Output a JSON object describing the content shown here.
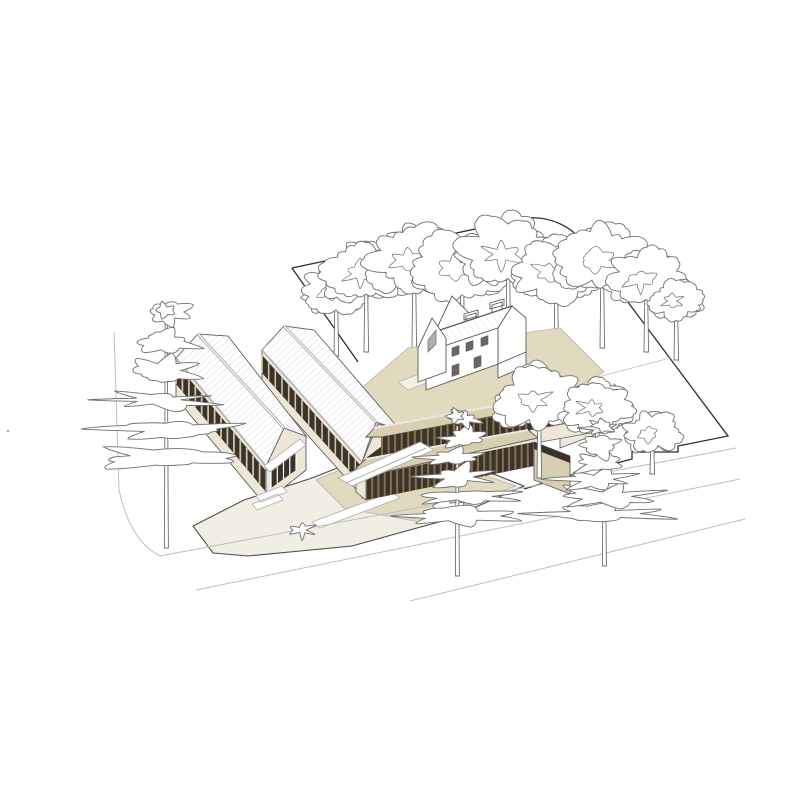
{
  "meta": {
    "title": "Architectural site illustration — axonometric view of a building complex",
    "style": "line drawing with muted tan fills, white background, no text labels"
  },
  "palette": {
    "bg": "#ffffff",
    "line": "#5a5a5a",
    "outline": "#4c4c4c",
    "boundary": "#2e2e2e",
    "trim": "#b3b3b3",
    "trimLight": "#e8e8e8",
    "street": "#bfbfbf",
    "treeLine": "#6f6f6f",
    "wallCream": "#ece7d7",
    "wallCream2": "#f3f0e6",
    "deckTan": "#d8cfb0",
    "groundTan": "#e2dabf",
    "groundCream": "#f1eee3",
    "glazing": "#3b332a",
    "finBrown": "#85714f",
    "mullionTan": "#cdc3a6",
    "roofHatch": "#dadada",
    "doorDark": "#40382c"
  },
  "scene": {
    "site": {
      "boundary_shape": "parallelogram with rounded top-right arc and notched lower-right edge",
      "streets": "curb lines with rounded corner at lower-left, fading to the right"
    },
    "buildings": {
      "gabled_halls": 2,
      "historic_house": 1,
      "colonnade_wings": 2,
      "hall_features": "white hatched roofs, dark clerestory bands with tan mullions, cream walls, glazed gable entrances",
      "wing_features": "tan roof decks, dark brown vertical fin colonnades, cream base walls"
    },
    "trees": {
      "back_row": [
        {
          "x": 336,
          "base_y": 356,
          "canopy_y": 290,
          "r": 30
        },
        {
          "x": 366,
          "base_y": 352,
          "canopy_y": 272,
          "r": 40
        },
        {
          "x": 414,
          "base_y": 348,
          "canopy_y": 258,
          "r": 44
        },
        {
          "x": 462,
          "base_y": 348,
          "canopy_y": 266,
          "r": 42
        },
        {
          "x": 508,
          "base_y": 344,
          "canopy_y": 252,
          "r": 46
        },
        {
          "x": 556,
          "base_y": 358,
          "canopy_y": 270,
          "r": 40
        },
        {
          "x": 602,
          "base_y": 348,
          "canopy_y": 258,
          "r": 42
        },
        {
          "x": 646,
          "base_y": 352,
          "canopy_y": 278,
          "r": 36
        },
        {
          "x": 676,
          "base_y": 360,
          "canopy_y": 300,
          "r": 24
        }
      ],
      "foreground": [
        {
          "kind": "pine",
          "x": 166,
          "base_y": 548,
          "top": 312,
          "spread": 54
        },
        {
          "kind": "deciduous",
          "x": 539,
          "base_y": 478,
          "canopy_y": 398,
          "r": 40
        },
        {
          "kind": "pine",
          "x": 457,
          "base_y": 576,
          "top": 418,
          "spread": 46
        },
        {
          "kind": "deciduous",
          "x": 597,
          "base_y": 462,
          "canopy_y": 406,
          "r": 34
        },
        {
          "kind": "pine",
          "x": 604,
          "base_y": 566,
          "top": 428,
          "spread": 46
        },
        {
          "kind": "deciduous",
          "x": 652,
          "base_y": 474,
          "canopy_y": 432,
          "r": 26
        }
      ],
      "shrubs": [
        {
          "x": 444,
          "y": 510,
          "r": 14
        },
        {
          "x": 302,
          "y": 530,
          "r": 10
        }
      ]
    }
  }
}
